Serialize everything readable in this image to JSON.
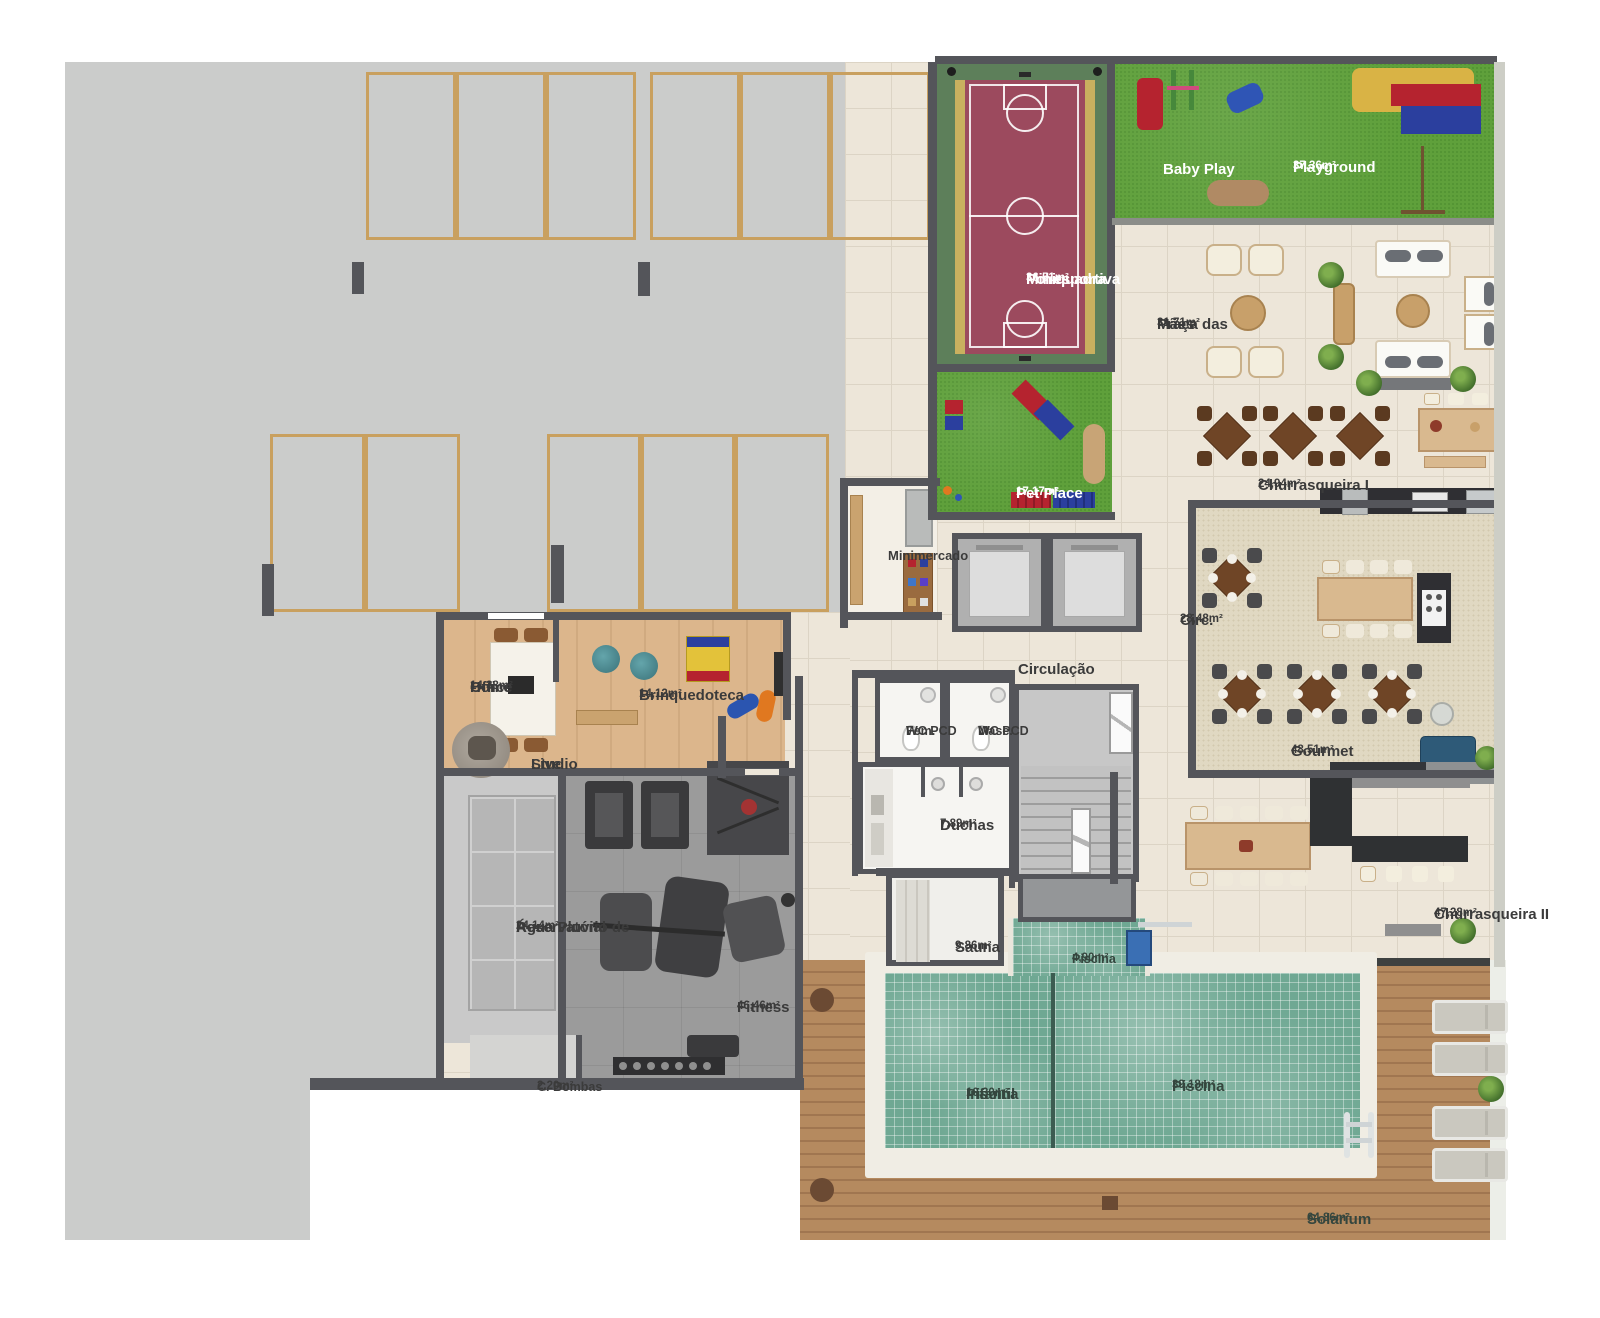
{
  "colors": {
    "concrete": "#cbcccb",
    "wall": "#54555a",
    "parking_line": "#c9a05f",
    "grass": "#5fa03b",
    "court_green": "#5d7f5a",
    "court_maroon": "#9c4a5e",
    "court_yellow": "#c9b05f",
    "tile": "#ede6d9",
    "tile_line": "#dcd4c5",
    "wood": "#dcb68c",
    "carpet": "#e0d8c2",
    "deck": "#b58a5f",
    "pool": "#6fa893",
    "gym_floor": "#9b9b9b",
    "label": "#3b3b3b",
    "label_light": "#ffffff",
    "pool_label": "#35463e"
  },
  "rooms": {
    "baby_play": {
      "line1": "Baby Play"
    },
    "playground": {
      "line1": "Playground",
      "area": "37,36m²"
    },
    "miniquadra": {
      "line1": "Miniquadra",
      "line2": "Poliesportiva",
      "area": "36,51m²"
    },
    "praca_das_maes": {
      "line1": "Praça das",
      "line2": "Mães",
      "area": "31,71m²"
    },
    "pet_place": {
      "line1": "Pet Place",
      "area": "17,17m²"
    },
    "churrasqueira_1": {
      "line1": "Churrasqueira I",
      "area": "24,94m²"
    },
    "minimercado": {
      "line1": "Minimercado"
    },
    "circ": {
      "line1": "Circ.",
      "area": "28,48m²"
    },
    "circulacao": {
      "line1": "Circulação"
    },
    "home_office": {
      "line1": "Home",
      "line2": "Office",
      "area": "14,38m²"
    },
    "brinquedoteca": {
      "line1": "Brinquedoteca",
      "area": "14,12m²"
    },
    "studio_live": {
      "line1": "Studio",
      "line2": "Live"
    },
    "wc_pcd_fem": {
      "line1": "WC PCD",
      "line2": "Fem."
    },
    "wc_pcd_masc": {
      "line1": "WC PCD",
      "line2": "Masc."
    },
    "duchas": {
      "line1": "Duchas",
      "area": "7,89m²"
    },
    "sauna": {
      "line1": "Sauna",
      "area": "9,86m²"
    },
    "piscina_sauna": {
      "line1": "Piscina",
      "area": "4,90m²"
    },
    "gourmet": {
      "line1": "Gourmet",
      "area": "48,51m²"
    },
    "reservatorio": {
      "line1": "Reservatório de",
      "line2": "Água Pluvial",
      "area": "24,14m²"
    },
    "fitness": {
      "line1": "Fitness",
      "area": "46,46m²"
    },
    "c_bombas": {
      "line1": "C. Bombas",
      "area": "2,20m²"
    },
    "churrasqueira_2": {
      "line1": "Churrasqueira II",
      "area": "47,28m²"
    },
    "piscina_infantil": {
      "line1": "Piscina",
      "line2": "Infantil",
      "area": "10,30m²"
    },
    "piscina": {
      "line1": "Piscina",
      "area": "39,18m²"
    },
    "solarium": {
      "line1": "Solarium",
      "area": "64,86m²"
    }
  }
}
